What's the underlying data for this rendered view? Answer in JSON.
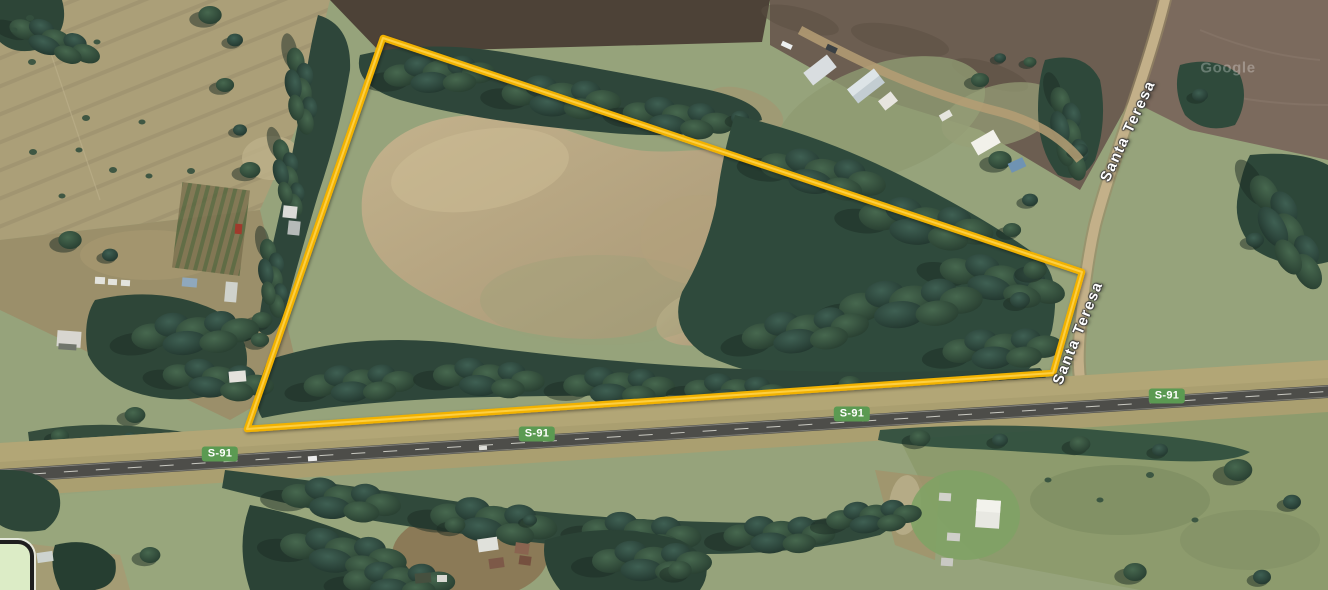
{
  "watermark": {
    "text": "Google"
  },
  "parcel": {
    "outline_color": "#f2b203",
    "vertices": "383,38 1082,272 1053,373 247,429"
  },
  "roads": {
    "highway": {
      "badge_label": "S-91",
      "badge_color": "#5b9a52"
    },
    "cross_street": {
      "name": "Santa Teresa"
    }
  }
}
